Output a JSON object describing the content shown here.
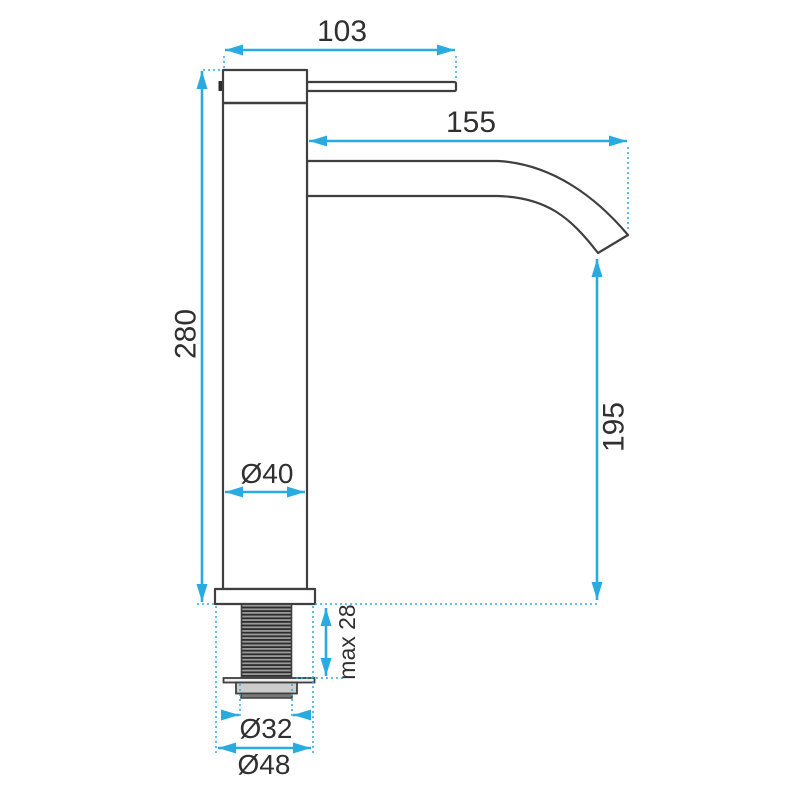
{
  "drawing": {
    "kind": "faucet-technical-dimension-drawing"
  },
  "colors": {
    "dimension_blue": "#29abe2",
    "outline_dark": "#3f3f3f",
    "text_dark": "#303030",
    "nut_gray": "#cccccc",
    "background": "#ffffff"
  },
  "dimensions": {
    "handle_length": "103",
    "spout_reach": "155",
    "body_height": "280",
    "spout_outlet_height": "195",
    "body_diameter": "Ø40",
    "max_mounting_thickness": "max 28",
    "thread_diameter": "Ø32",
    "base_diameter": "Ø48"
  }
}
